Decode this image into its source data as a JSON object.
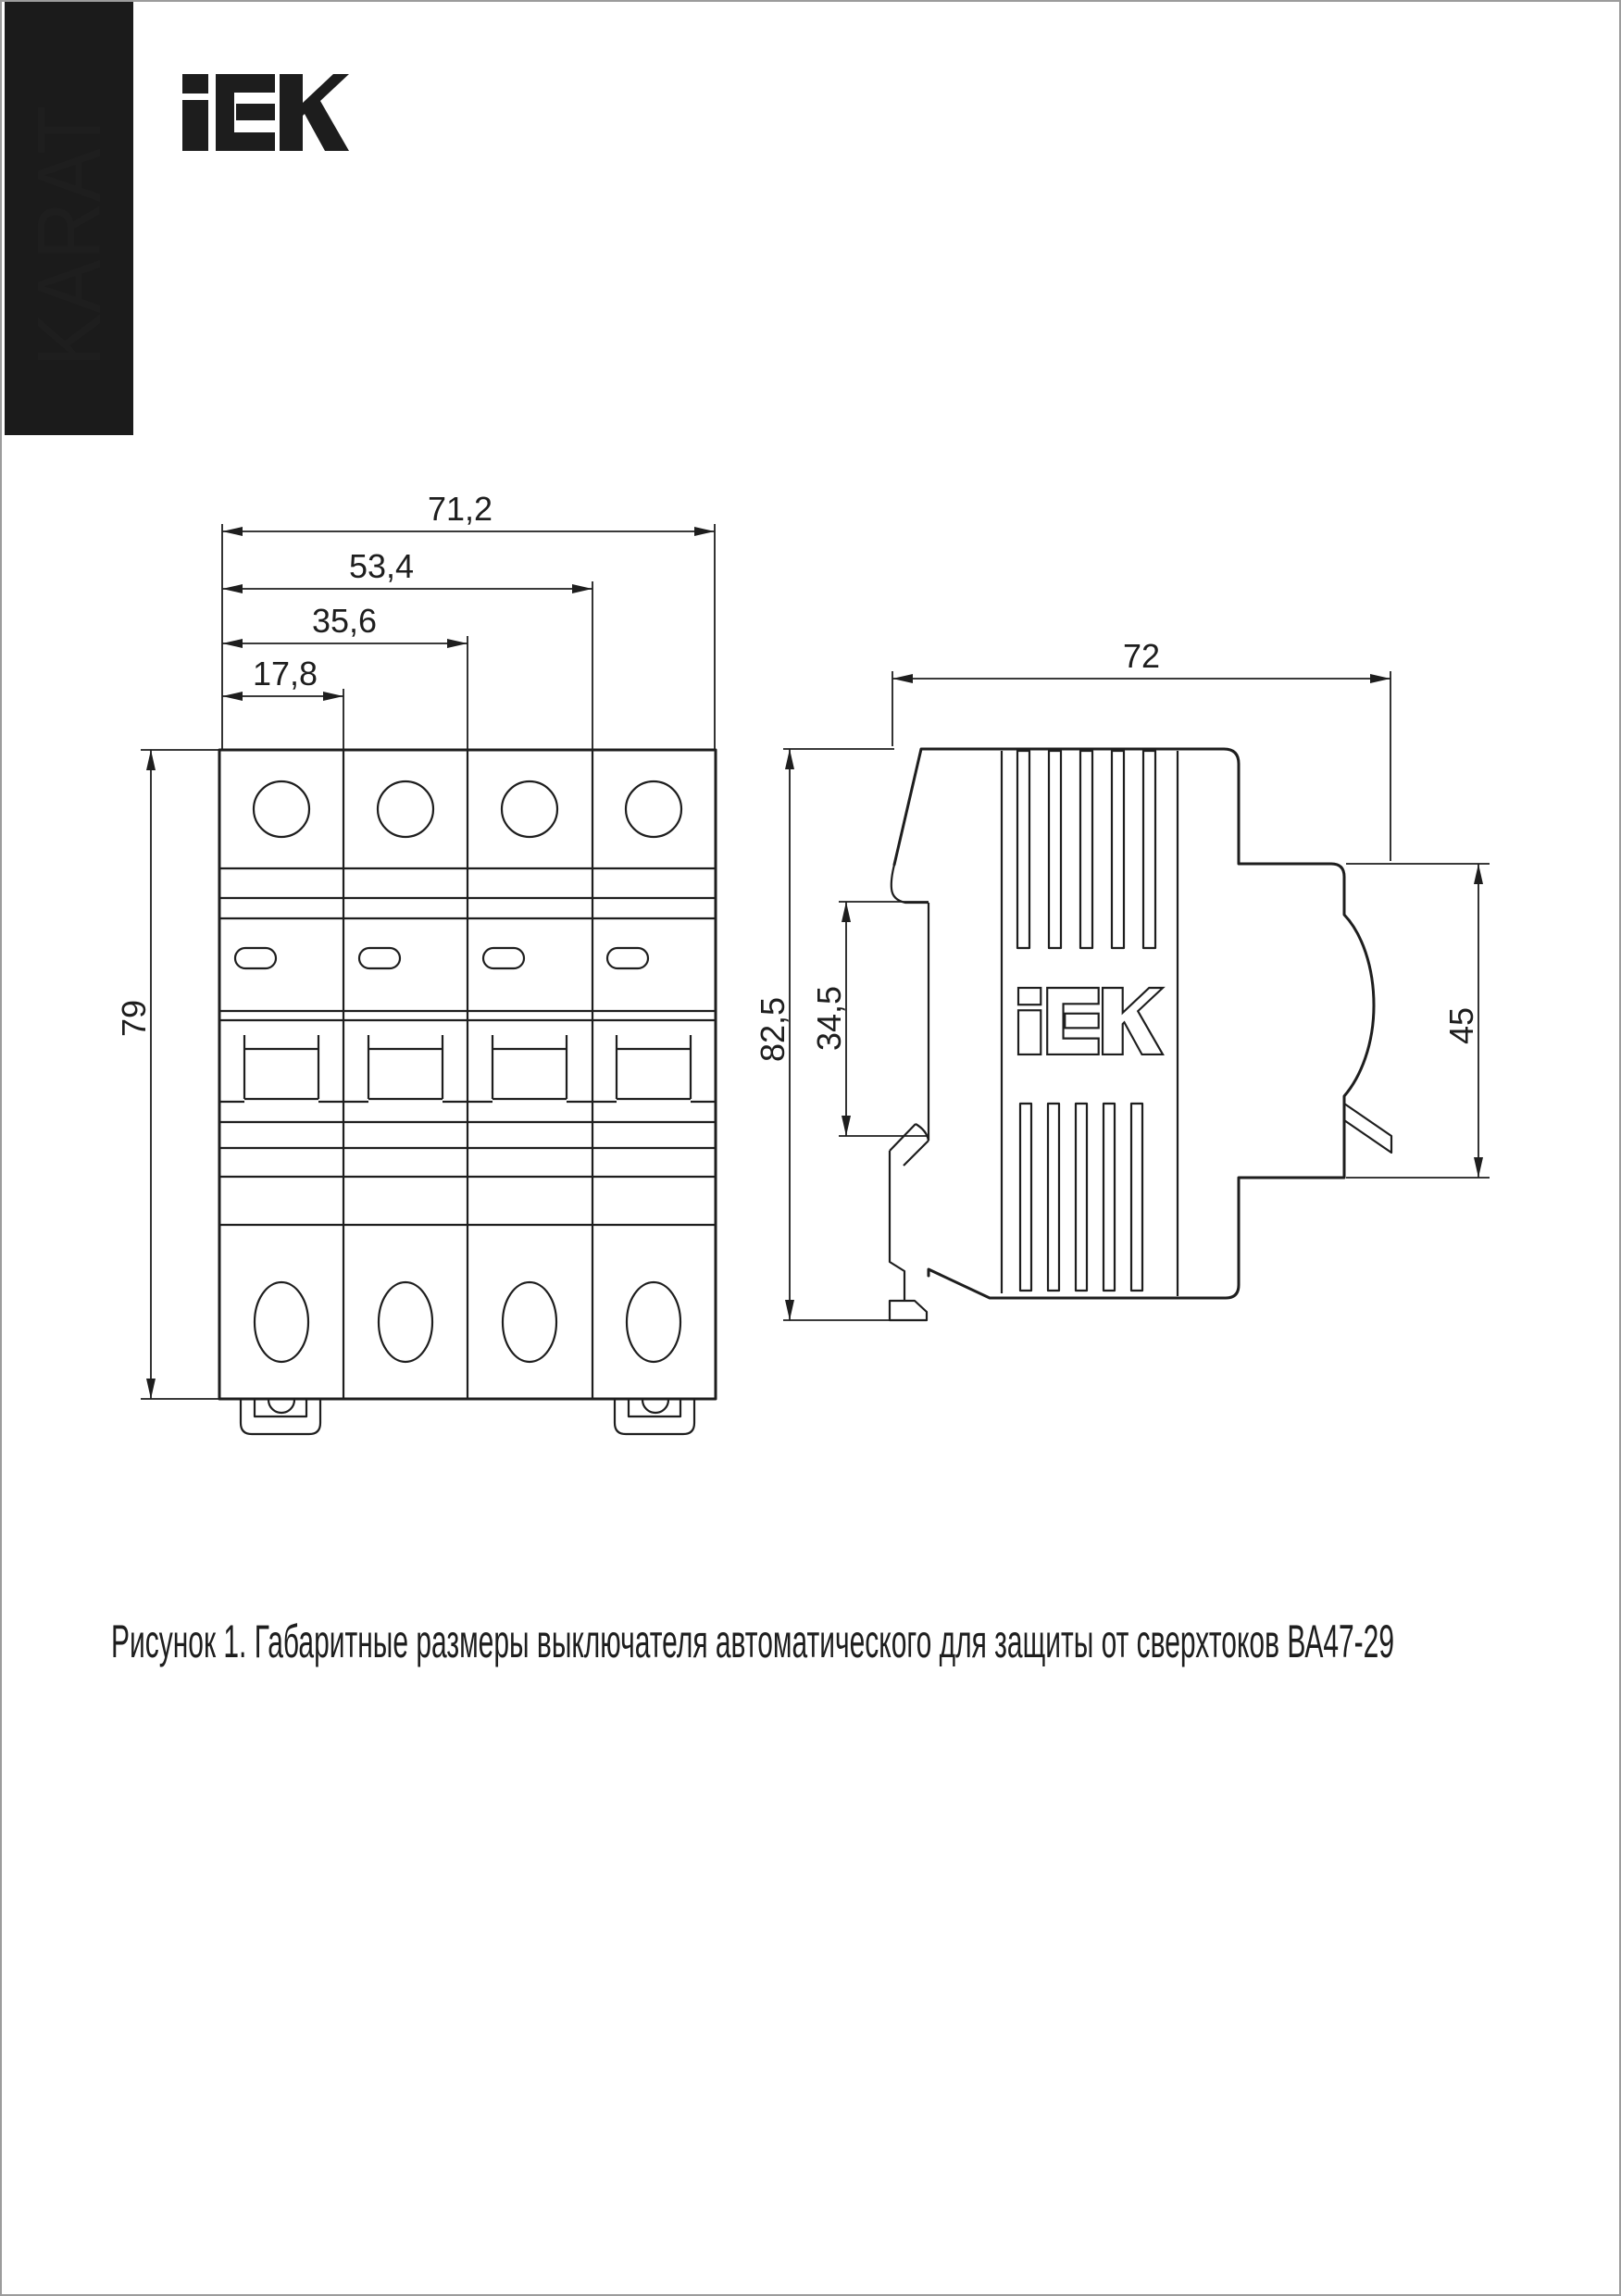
{
  "brand": {
    "karat": "KARAT",
    "iek": "IEK"
  },
  "figure": {
    "front_view": {
      "dim_width_total": "71,2",
      "dim_width_three_poles": "53,4",
      "dim_width_two_poles": "35,6",
      "dim_width_one_pole": "17,8",
      "dim_height": "79"
    },
    "side_view": {
      "dim_depth": "72",
      "dim_height_total": "82,5",
      "dim_rail_window": "34,5",
      "dim_front_width": "45",
      "logo": "IEK"
    }
  },
  "caption": {
    "text": "Рисунок 1. Габаритные размеры выключателя автоматического для защиты от сверхтоков ВА47-29"
  }
}
